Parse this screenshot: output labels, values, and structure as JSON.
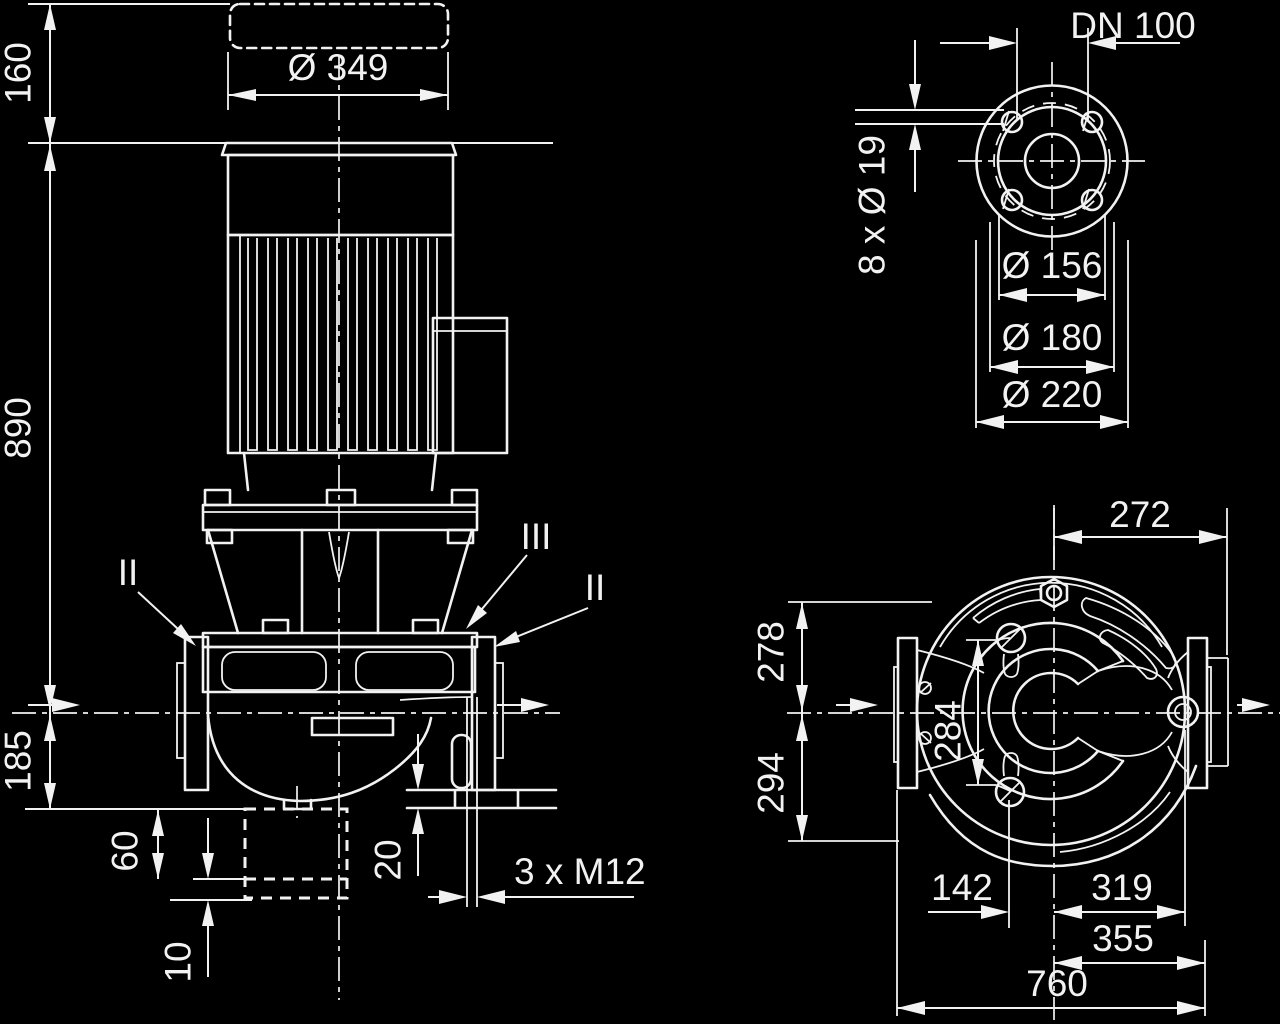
{
  "colors": {
    "background": "#000000",
    "ink": "#f2f2f2"
  },
  "views": {
    "elevation": {
      "dims": {
        "clearance_160": "160",
        "height_890": "890",
        "base_185": "185",
        "motor_dia": "Ø 349",
        "found_60": "60",
        "shim_10": "10",
        "foot_20": "20",
        "tap": "3 x M12"
      },
      "sections": {
        "left": "II",
        "mid": "III",
        "right": "II"
      }
    },
    "flange": {
      "dims": {
        "dn": "DN 100",
        "bolts": "8 x Ø 19",
        "d156": "Ø 156",
        "d180": "Ø 180",
        "d220": "Ø 220"
      }
    },
    "plan": {
      "dims": {
        "w272": "272",
        "w278": "278",
        "w294": "294",
        "w284": "284",
        "w142": "142",
        "w319": "319",
        "w355": "355",
        "w760": "760"
      }
    }
  }
}
